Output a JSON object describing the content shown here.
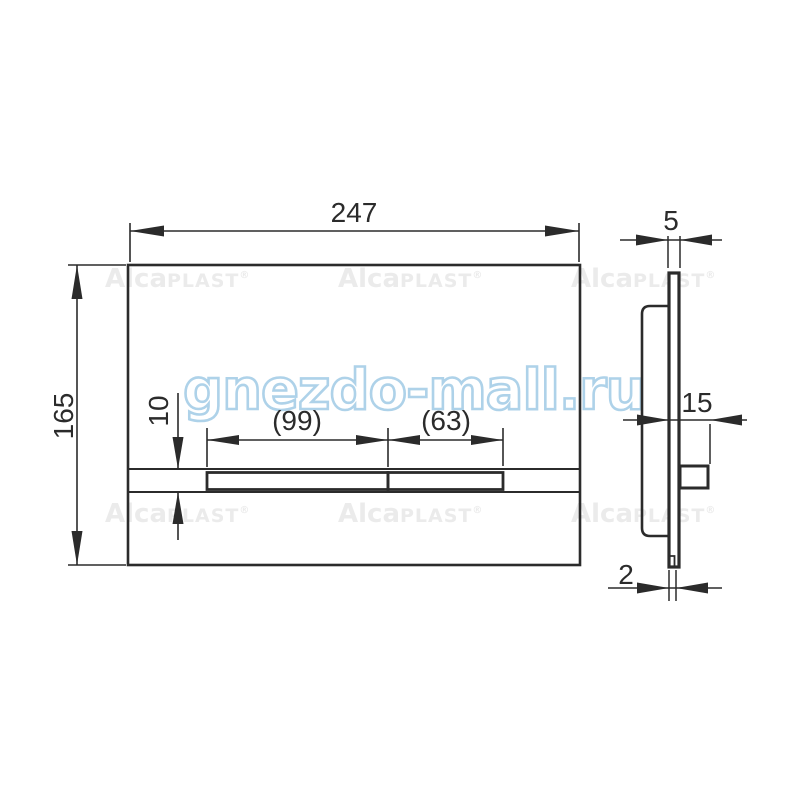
{
  "drawing": {
    "type": "technical-dimension-drawing",
    "subject": "flush plate front and side views",
    "line_color": "#2b2b2b"
  },
  "front_view": {
    "width_label": "247",
    "height_label": "165",
    "button_large_label": "(99)",
    "button_small_label": "(63)",
    "band_height_label": "10"
  },
  "side_view": {
    "thickness_label": "5",
    "depth_label": "15",
    "rail_label": "2"
  },
  "watermarks": {
    "brand_alca": "Alca",
    "brand_plast": "PLAST",
    "brand_reg": "®",
    "brand_color": "#ebebeb",
    "site": "gnezdo-mall.ru",
    "site_outline_color": "#aed2e9"
  }
}
